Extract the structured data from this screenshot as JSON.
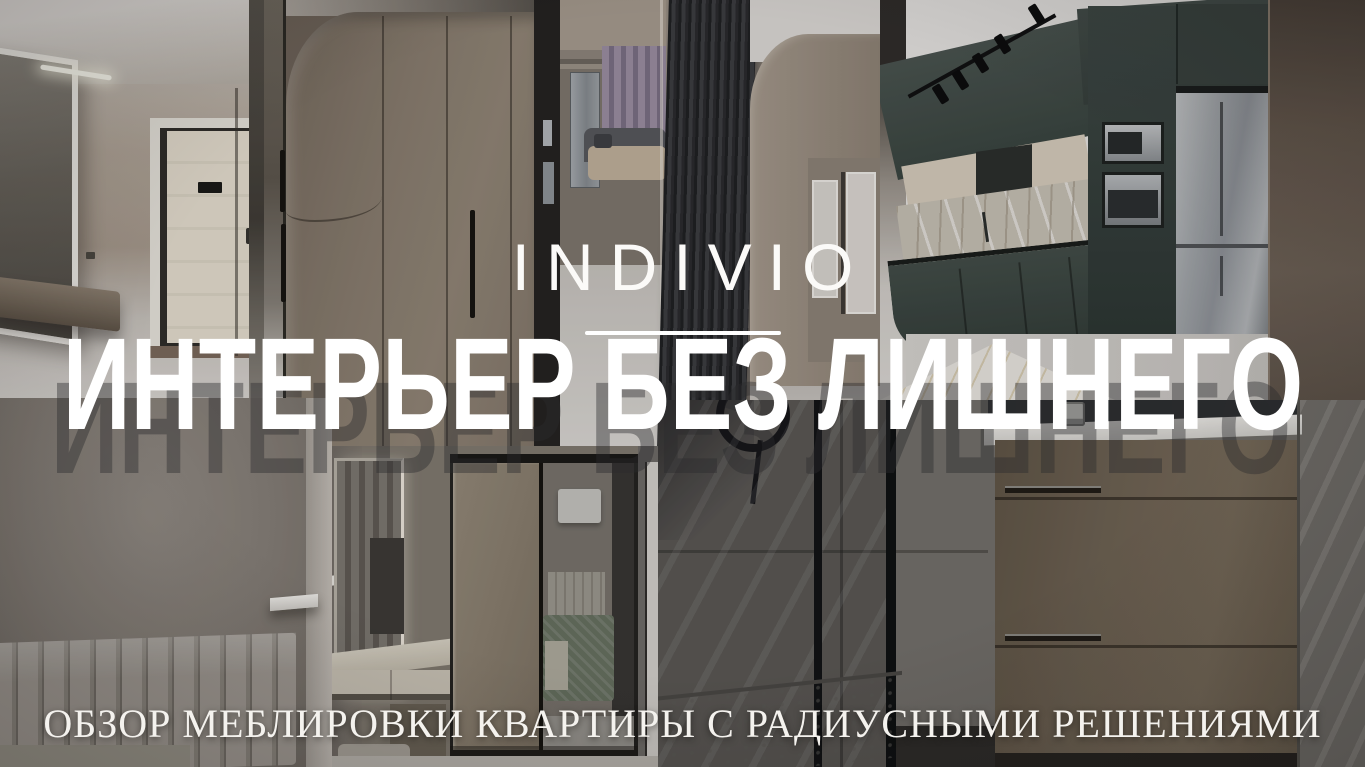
{
  "overlay": {
    "brand": "INDIVIO",
    "title": "ИНТЕРЬЕР БЕЗ ЛИШНЕГО",
    "subtitle": "ОБЗОР МЕБЛИРОВКИ КВАРТИРЫ С РАДИУСНЫМИ РЕШЕНИЯМИ",
    "colors": {
      "text": "#ffffff",
      "title_shadow": "rgba(44,42,46,0.42)",
      "divider": "#ffffff"
    }
  },
  "collage": {
    "photos": [
      {
        "id": "hallway-entry",
        "subject": "entry hallway with mirror, console and cream front door",
        "palette": [
          "#b3a79a",
          "#e7e0d1",
          "#2f2d2a"
        ]
      },
      {
        "id": "radius-wardrobe",
        "subject": "taupe wardrobe with rounded corner and black handles",
        "palette": [
          "#897d6f",
          "#15130f"
        ]
      },
      {
        "id": "living-slat-column",
        "subject": "living room behind dark slat column, curtains and sofa",
        "palette": [
          "#2a2b2e",
          "#9c8fa3",
          "#c2b29c"
        ]
      },
      {
        "id": "kitchen-graphite",
        "subject": "graphite green kitchen, marble backsplash, steel fridge, track lights",
        "palette": [
          "#3c4643",
          "#d8cdbd",
          "#a3a7ab"
        ]
      },
      {
        "id": "bedroom-headboard",
        "subject": "grey channel-tufted headboard wall with white lamp",
        "palette": [
          "#8d877f",
          "#f5f3ef"
        ]
      },
      {
        "id": "bedroom-vanity-wardrobe",
        "subject": "floating vanity with mirror and mirrored sliding wardrobe",
        "palette": [
          "#cfc8ba",
          "#8b847c",
          "#76806c"
        ]
      },
      {
        "id": "bathroom-shower-vanity",
        "subject": "glass shower with concrete tiles and bronze drawer vanity",
        "palette": [
          "#74706b",
          "#6e6253",
          "#0d0f11"
        ]
      }
    ]
  }
}
